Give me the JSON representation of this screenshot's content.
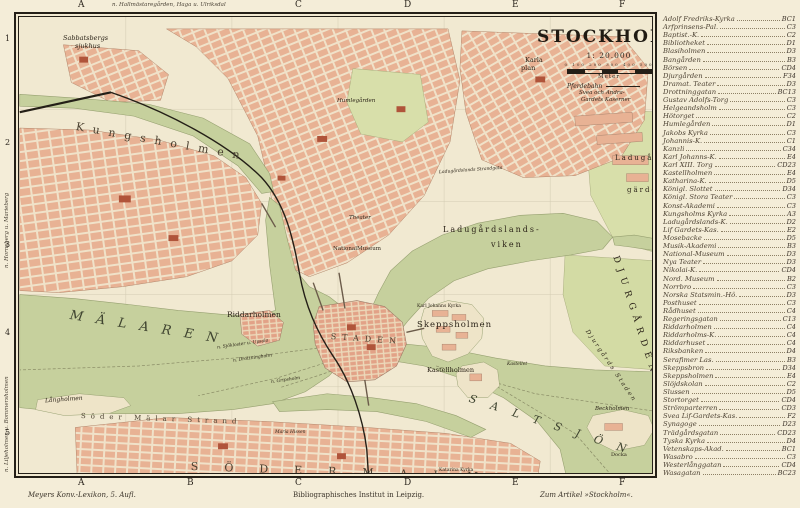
{
  "plate": {
    "title": "STOCKHOLM",
    "scale_text": "1: 20.000",
    "scale_ticks_text": "0   100   200   300   400   500",
    "scale_unit": "Meter",
    "legend_pferdebahn": "Pferdebahn",
    "top_note": "n. Hallmästaregården, Haga u. Ulriksdal",
    "left_note_upper": "n. Hornsberg u. Marieberg",
    "left_note_lower": "n. Liljeholmen u. Bommersholmen",
    "caption_left": "Meyers Konv.-Lexikon, 5. Aufl.",
    "caption_center": "Bibliographisches Institut in Leipzig.",
    "caption_right": "Zum Artikel »Stockholm«.",
    "grid": {
      "top_letters": [
        "A",
        "C",
        "D",
        "E",
        "F"
      ],
      "bottom_letters": [
        "A",
        "B",
        "C",
        "D",
        "E",
        "F"
      ],
      "left_numbers": [
        "1",
        "2",
        "3",
        "4",
        "5"
      ]
    }
  },
  "map": {
    "labels": {
      "sabbatsberg1": "Sabbatsbergs",
      "sabbatsberg2": "sjukhus",
      "karlaplan1": "Karla",
      "karlaplan2": "plan",
      "kaserner1": "Svea och Andra-",
      "kaserner2": "Gardets Kaserner",
      "ladugards1": "Ladugårds-",
      "ladugards2": "gärdet",
      "strandgata": "Ladugårdslands Strandgata",
      "theater": "Theater",
      "nationalmuseum": "NationalMuseum",
      "viken1": "Ladugårdslands-",
      "viken2": "viken",
      "djurgarden": "DJURGÅRDEN",
      "humlegarden": "Humlegården",
      "kungsholmen": "Kungsholmen",
      "riddarholmen": "Riddarholmen",
      "malaren": "MÄLAREN",
      "staden": "STADEN",
      "skeppsholmen": "Skeppsholmen",
      "karljohann": "Karl Johanns Kyrka",
      "kastellholmen": "Kastellholmen",
      "kastellet": "Kastellet",
      "beckholmen": "Beckholmen",
      "docka": "Docka",
      "djurgardsstaden": "Djurgårds Staden",
      "langholmen": "Långholmen",
      "sodermalarstrand": "Söder Mälar Strand",
      "mariahissen": "Maria Hissen",
      "sodermalm": "SÖDERMALM",
      "saltsjon": "SALTSJÖN",
      "katarina": "Katarina Kyrka",
      "ferry1": "n. Sjökloster u. Upsala",
      "ferry2": "n. Drottningholm",
      "ferry3": "n. Gripsholm"
    }
  },
  "index": {
    "entries": [
      {
        "name": "Adolf Fredriks-Kyrka",
        "ref": "BC1"
      },
      {
        "name": "Arfprinsens-Pal.",
        "ref": "C3"
      },
      {
        "name": "Baptist.-K.",
        "ref": "C2"
      },
      {
        "name": "Bibliotheket",
        "ref": "D1"
      },
      {
        "name": "Blasiholmen",
        "ref": "D3"
      },
      {
        "name": "Bangården",
        "ref": "B3"
      },
      {
        "name": "Börsen",
        "ref": "CD4"
      },
      {
        "name": "Djurgården",
        "ref": "F34"
      },
      {
        "name": "Dramat. Teater",
        "ref": "D3"
      },
      {
        "name": "Drottninggatan",
        "ref": "BC13"
      },
      {
        "name": "Gustav Adolfs-Torg",
        "ref": "C3"
      },
      {
        "name": "Helgeandsholm",
        "ref": "C3"
      },
      {
        "name": "Hötorget",
        "ref": "C2"
      },
      {
        "name": "Humlegården",
        "ref": "D1"
      },
      {
        "name": "Jakobs Kyrka",
        "ref": "C3"
      },
      {
        "name": "Johannis-K.",
        "ref": "C1"
      },
      {
        "name": "Kanzli",
        "ref": "C34"
      },
      {
        "name": "Karl Johanns-K.",
        "ref": "E4"
      },
      {
        "name": "Karl XIII. Torg",
        "ref": "CD23"
      },
      {
        "name": "Kastellholmen",
        "ref": "E4"
      },
      {
        "name": "Katharina-K.",
        "ref": "D5"
      },
      {
        "name": "Königl. Slottet",
        "ref": "D34"
      },
      {
        "name": "Königl. Stora Teater",
        "ref": "C3"
      },
      {
        "name": "Konst-Akademi",
        "ref": "C3"
      },
      {
        "name": "Kungsholms Kyrka",
        "ref": "A3"
      },
      {
        "name": "Ladugårdslands-K.",
        "ref": "D2"
      },
      {
        "name": "Lif Gardets-Kas.",
        "ref": "E2"
      },
      {
        "name": "Mosebacke",
        "ref": "D5"
      },
      {
        "name": "Musik-Akademi",
        "ref": "B3"
      },
      {
        "name": "National-Museum",
        "ref": "D3"
      },
      {
        "name": "Nya Teater",
        "ref": "D3"
      },
      {
        "name": "Nikolai-K.",
        "ref": "CD4"
      },
      {
        "name": "Nord. Museum",
        "ref": "B2"
      },
      {
        "name": "Norrbro",
        "ref": "C3"
      },
      {
        "name": "Norska Statsmin.-Hô.",
        "ref": "D3"
      },
      {
        "name": "Posthuset",
        "ref": "C3"
      },
      {
        "name": "Rådhuset",
        "ref": "C4"
      },
      {
        "name": "Regeringsgatan",
        "ref": "C13"
      },
      {
        "name": "Riddarholmen",
        "ref": "C4"
      },
      {
        "name": "Riddarholms-K.",
        "ref": "C4"
      },
      {
        "name": "Riddarhuset",
        "ref": "C4"
      },
      {
        "name": "Riksbanken",
        "ref": "D4"
      },
      {
        "name": "Serafimer Las.",
        "ref": "B3"
      },
      {
        "name": "Skeppsbron",
        "ref": "D34"
      },
      {
        "name": "Skeppsholmen",
        "ref": "E4"
      },
      {
        "name": "Slöjdskolan",
        "ref": "C2"
      },
      {
        "name": "Slussen",
        "ref": "D5"
      },
      {
        "name": "Stortorget",
        "ref": "CD4"
      },
      {
        "name": "Strömparterren",
        "ref": "CD3"
      },
      {
        "name": "Svea Lif-Gardets-Kas.",
        "ref": "F2"
      },
      {
        "name": "Synagoge",
        "ref": "D23"
      },
      {
        "name": "Trädgårdsgatan",
        "ref": "CD23"
      },
      {
        "name": "Tyska Kyrka",
        "ref": "D4"
      },
      {
        "name": "Vetenskaps-Akad.",
        "ref": "BC1"
      },
      {
        "name": "Wasabro",
        "ref": "C3"
      },
      {
        "name": "Westerlånggatan",
        "ref": "CD4"
      },
      {
        "name": "Wasagatan",
        "ref": "BC23"
      }
    ]
  },
  "colors": {
    "paper": "#f4edd8",
    "water": "#c6d09d",
    "park": "#d8dfaa",
    "blocks": "#e8b294",
    "accent_building": "#b0543a",
    "ink": "#241f17"
  }
}
